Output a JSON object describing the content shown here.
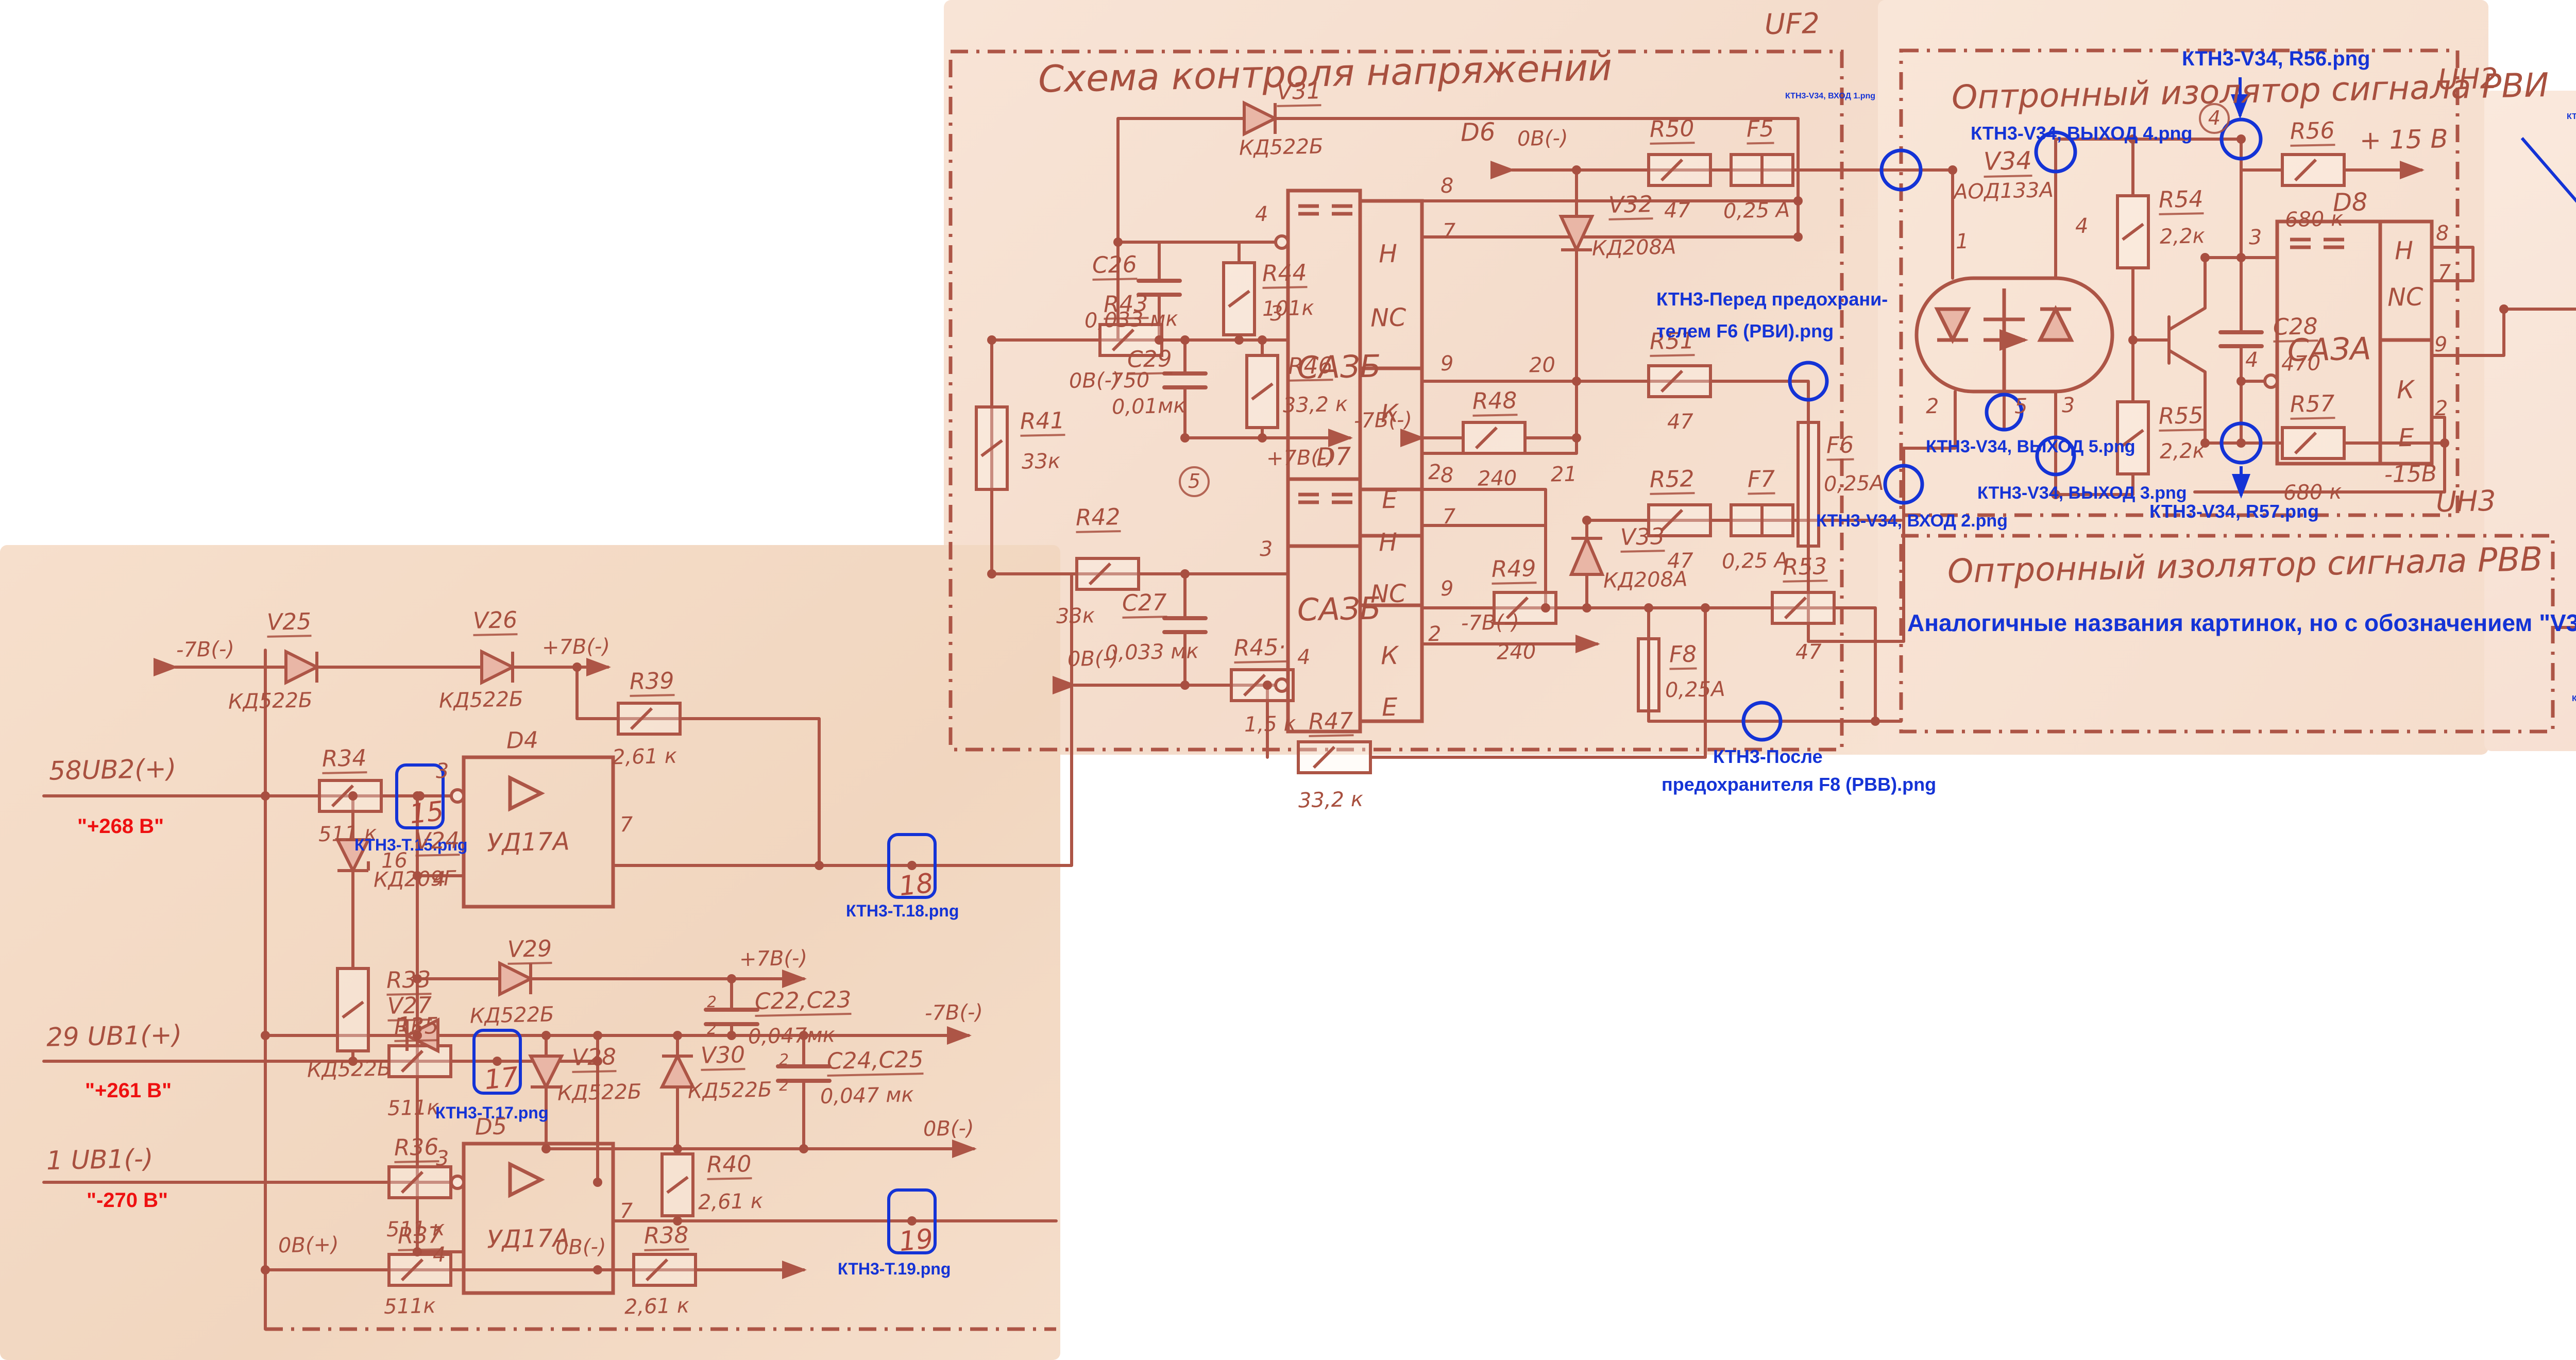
{
  "t": {
    "uf2_title": "Схема контроля напряжений",
    "uh2_title": "Оптронный изолятор сигнала РВИ",
    "uh3_title": "Оптронный изолятор сигнала РВВ",
    "uf2_tag": "UF2",
    "uh2_tag": "UH2",
    "uh3_tag": "UH3"
  },
  "c": {
    "v24": {
      "r": "V24",
      "v": "КД209Г"
    },
    "v25": {
      "r": "V25",
      "v": "КД522Б"
    },
    "v26": {
      "r": "V26",
      "v": "КД522Б"
    },
    "v27": {
      "r": "V27",
      "v": "КД522Б"
    },
    "v28": {
      "r": "V28",
      "v": "КД522Б"
    },
    "v29": {
      "r": "V29",
      "v": "КД522Б"
    },
    "v30": {
      "r": "V30",
      "v": "КД522Б"
    },
    "v31": {
      "r": "V31",
      "v": "КД522Б"
    },
    "v32": {
      "r": "V32",
      "v": "КД208А"
    },
    "v33": {
      "r": "V33",
      "v": "КД208А"
    },
    "v34": {
      "r": "V34",
      "v": "АОД133А"
    },
    "r33": {
      "r": "R33",
      "v": "1к"
    },
    "r34": {
      "r": "R34",
      "v": "511 к"
    },
    "r35": {
      "r": "R35",
      "v": "511к"
    },
    "r36": {
      "r": "R36",
      "v": "511 к"
    },
    "r37": {
      "r": "R37",
      "v": "511к"
    },
    "r38": {
      "r": "R38",
      "v": "2,61 к"
    },
    "r39": {
      "r": "R39",
      "v": "2,61 к"
    },
    "r40": {
      "r": "R40",
      "v": "2,61 к"
    },
    "r41": {
      "r": "R41",
      "v": "33к"
    },
    "r42": {
      "r": "R42",
      "v": "33к"
    },
    "r43": {
      "r": "R43",
      "v": "750"
    },
    "r44": {
      "r": "R44",
      "v": "101к"
    },
    "r45": {
      "r": "R45·",
      "v": "1,5 к"
    },
    "r46": {
      "r": "R46",
      "v": "33,2 к"
    },
    "r47": {
      "r": "R47",
      "v": "33,2 к"
    },
    "r48": {
      "r": "R48",
      "v": "240"
    },
    "r49": {
      "r": "R49",
      "v": "240"
    },
    "r50": {
      "r": "R50",
      "v": "47"
    },
    "r51": {
      "r": "R51",
      "v": "47"
    },
    "r52": {
      "r": "R52",
      "v": "47"
    },
    "r53": {
      "r": "R53",
      "v": "47"
    },
    "r54": {
      "r": "R54",
      "v": "2,2к"
    },
    "r55": {
      "r": "R55",
      "v": "2,2к"
    },
    "r56": {
      "r": "R56",
      "v": "680 к"
    },
    "r57": {
      "r": "R57",
      "v": "680 к"
    },
    "c22_23": {
      "r": "C22,C23",
      "v": "0,047мк"
    },
    "c24_25": {
      "r": "C24,C25",
      "v": "0,047 мк"
    },
    "c26": {
      "r": "C26",
      "v": "0,033 мк"
    },
    "c27": {
      "r": "C27",
      "v": "0,033 мк"
    },
    "c28": {
      "r": "C28",
      "v": "470"
    },
    "c29": {
      "r": "C29",
      "v": "0,01мк"
    },
    "f5": {
      "r": "F5",
      "v": "0,25 А"
    },
    "f6": {
      "r": "F6",
      "v": "0,25А"
    },
    "f7": {
      "r": "F7",
      "v": "0,25 А"
    },
    "f8": {
      "r": "F8",
      "v": "0,25А"
    },
    "d4": {
      "r": "D4",
      "v": "УД17А"
    },
    "d5": {
      "r": "D5",
      "v": "УД17А"
    },
    "d6": {
      "r": "D6",
      "v": "САЗБ"
    },
    "d7": {
      "r": "D7",
      "v": "САЗБ"
    },
    "d8": {
      "r": "D8",
      "v": "САЗА"
    }
  },
  "cell": {
    "h": "Н",
    "nc": "NC",
    "k": "К",
    "e": "Е"
  },
  "p": {
    "1": "1",
    "2": "2",
    "3": "3",
    "4": "4",
    "5": "5",
    "7": "7",
    "8": "8",
    "9": "9"
  },
  "n": {
    "16": "16",
    "20": "20",
    "21": "21",
    "c4": "4",
    "c5": "5",
    "x2": "2"
  },
  "rl": {
    "m7": "-7В(-)",
    "p7": "+7В(-)",
    "z0m": "0В(-)",
    "z0p": "0В(+)",
    "p15": "+ 15 В",
    "m15": "-15В"
  },
  "io": {
    "in58": "58UB2(+)",
    "in29": "29 UB1(+)",
    "in1": "1 UB1(-)",
    "rvi": "РВИ",
    "rvi_n": "22",
    "rvi_pin": "16",
    "rvv": "РВВ",
    "rvv_n": "23",
    "rvv_pin": "15",
    "x14": "X1.4"
  },
  "tp": {
    "t15": "15",
    "t17": "17",
    "t18": "18",
    "t19": "19"
  },
  "a": {
    "r56": "КТН3-V34, R56.png",
    "vhod1": "КТН3-V34, ВХОД 1.png",
    "vyhod4": "КТН3-V34, ВЫХОД 4.png",
    "pered1": "КТН3-Перед предохрани-",
    "pered2": "телем F6 (РВИ).png",
    "vyhod5": "КТН3-V34, ВЫХОД 5.png",
    "vhod2": "КТН3-V34, ВХОД 2.png",
    "vyhod3": "КТН3-V34, ВЫХОД 3.png",
    "r57": "КТН3-V34, R57.png",
    "posle1": "КТН3-После",
    "posle2": "предохранителя F8 (РВВ).png",
    "t15": "КТН3-Т.15.png",
    "t17": "КТН3-Т.17.png",
    "t18": "КТН3-Т.18.png",
    "t19": "КТН3-Т.19.png",
    "out16": "КТН3-ВЫХОД 16 - РВИ.png",
    "out15": "КТН3-ВЫХОД 15 - РВВ.png",
    "analog": "Аналогичные названия картинок, но с обозначением \"V35\"",
    "norm1": "В нормальном состоянии",
    "norm2": "должен быть сигнал \"-15 В\""
  },
  "rd": {
    "fact": "По факту:",
    "rvi_v": "\"+4.66 В\"",
    "rvv_v": "\"-14.56 В\"",
    "u268": "\"+268 В\"",
    "u261": "\"+261 В\"",
    "u270": "\"-270 В\""
  }
}
